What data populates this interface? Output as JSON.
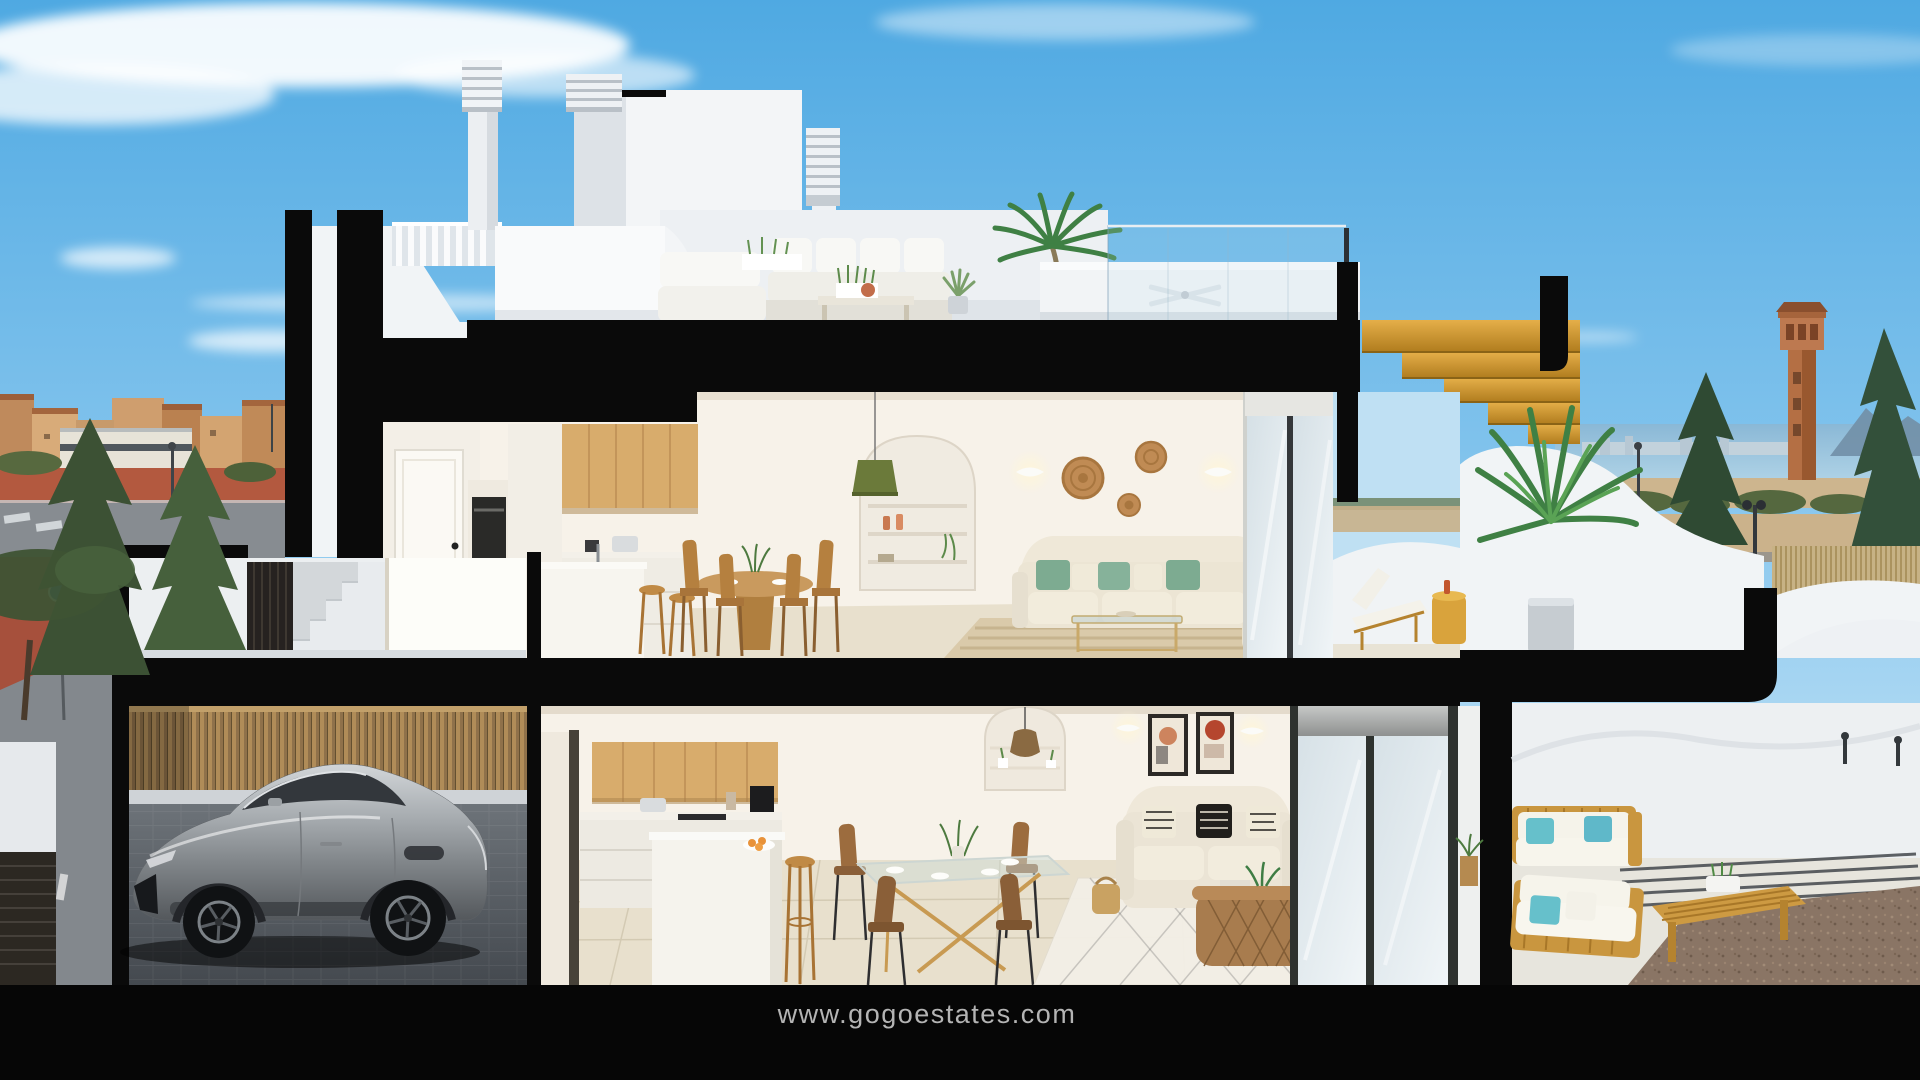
{
  "watermark": {
    "text": "www.gogoestates.com"
  },
  "colors": {
    "sky_top": "#4fa9e2",
    "sky_horizon": "#cfe8f8",
    "section_cut": "#0a0a0a",
    "exterior_wall": "#f1f4f6",
    "interior_wall": "#f7f2e9",
    "wood_cabinet": "#d8ac6c",
    "golden_wood": "#d9a53e",
    "sofa_cream": "#ece5d4",
    "pillow_green": "#7dab91",
    "pillow_turquoise": "#66c0cb",
    "car_silver": "#a6abaf",
    "fence_wood": "#b08c58",
    "floor_beige": "#e8e0cd",
    "sea": "#8ab8d6",
    "tower_terracotta": "#b46f44",
    "watermark_text": "#b4b4b4",
    "footer_background": "#060606"
  }
}
